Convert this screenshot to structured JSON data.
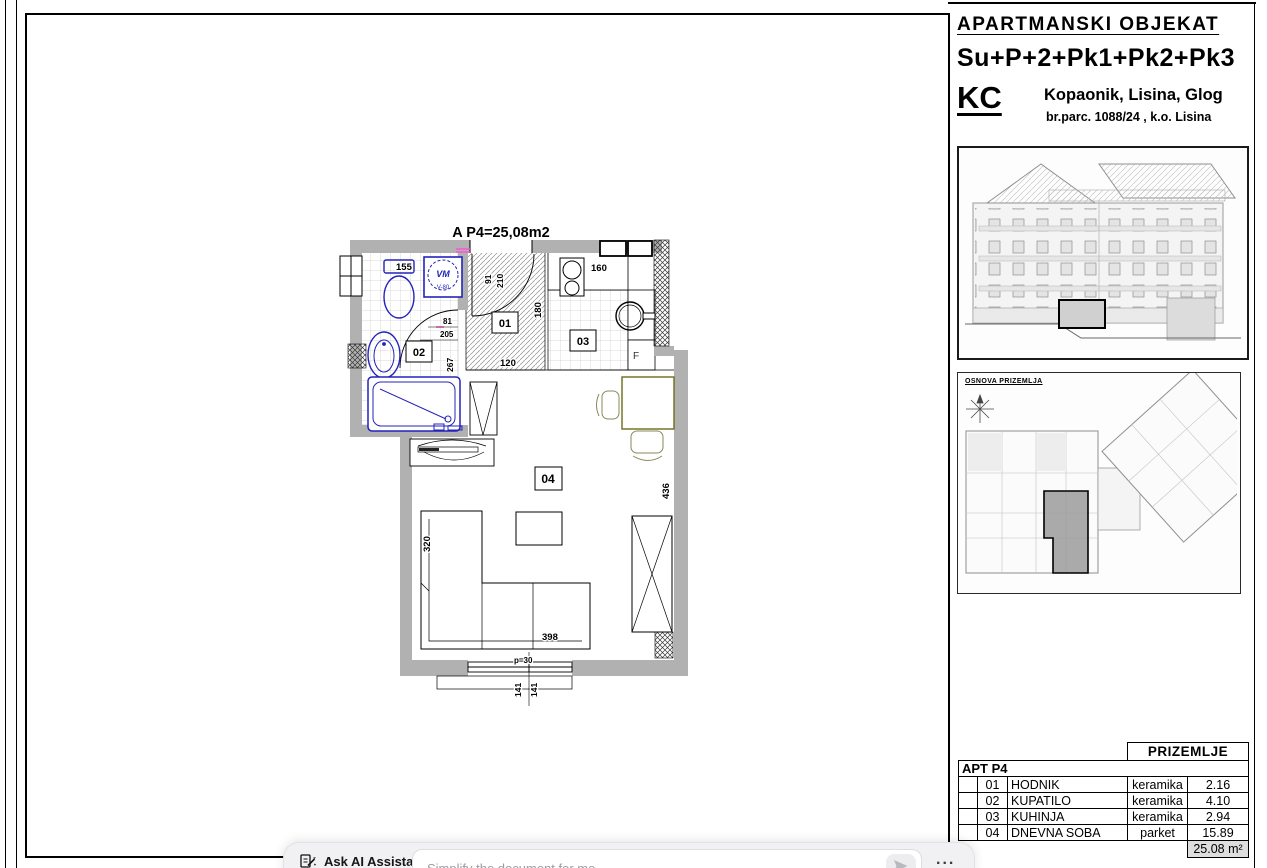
{
  "sheet": {
    "plan_title": "A P4=25,08m2",
    "rooms": {
      "hall": "01",
      "bath": "02",
      "kitchen": "03",
      "living": "04"
    },
    "fixtures": {
      "washing_machine": "VM",
      "washing_machine_code": "V-80",
      "fridge": "F"
    },
    "dims": {
      "bath_top": "155",
      "entry_width": "91",
      "entry_height": "210",
      "kitchen_top": "160",
      "hall_depth": "180",
      "hall_width": "120",
      "bath_d1": "81",
      "bath_d2": "205",
      "bath_depth": "267",
      "living_depth": "436",
      "living_side": "320",
      "living_front": "398",
      "parapet": "p=30",
      "window_left": "141",
      "window_right": "141"
    }
  },
  "title_block": {
    "project": "APARTMANSKI  OBJEKAT",
    "floors": "Su+P+2+Pk1+Pk2+Pk3",
    "initials": "KC",
    "location": "Kopaonik, Lisina, Glog",
    "parcel": "br.parc. 1088/24 ,  k.o. Lisina"
  },
  "thumbnails": {
    "plan_label": "OSNOVA PRIZEMLJA"
  },
  "area_table": {
    "header": "PRIZEMLJE",
    "apartment": "APT  P4",
    "rows": [
      {
        "num": "01",
        "name": "HODNIK",
        "material": "keramika",
        "area": "2.16"
      },
      {
        "num": "02",
        "name": "KUPATILO",
        "material": "keramika",
        "area": "4.10"
      },
      {
        "num": "03",
        "name": "KUHINJA",
        "material": "keramika",
        "area": "2.94"
      },
      {
        "num": "04",
        "name": "DNEVNA SOBA",
        "material": "parket",
        "area": "15.89"
      }
    ],
    "total": "25.08 m²"
  },
  "ai_bar": {
    "label": "Ask AI Assistant",
    "placeholder": "Simplify the document for me",
    "menu": "...",
    "icons": {
      "assistant": "document-pencil-icon",
      "send": "paper-plane-icon",
      "menu": "ellipsis-icon"
    }
  },
  "colors": {
    "wall_gray": "#b1b1b1",
    "fixture_blue": "#2323bb",
    "accent_magenta": "#ff4fd6",
    "table_shade": "#dedede",
    "furniture_olive": "#6b6b1a"
  }
}
